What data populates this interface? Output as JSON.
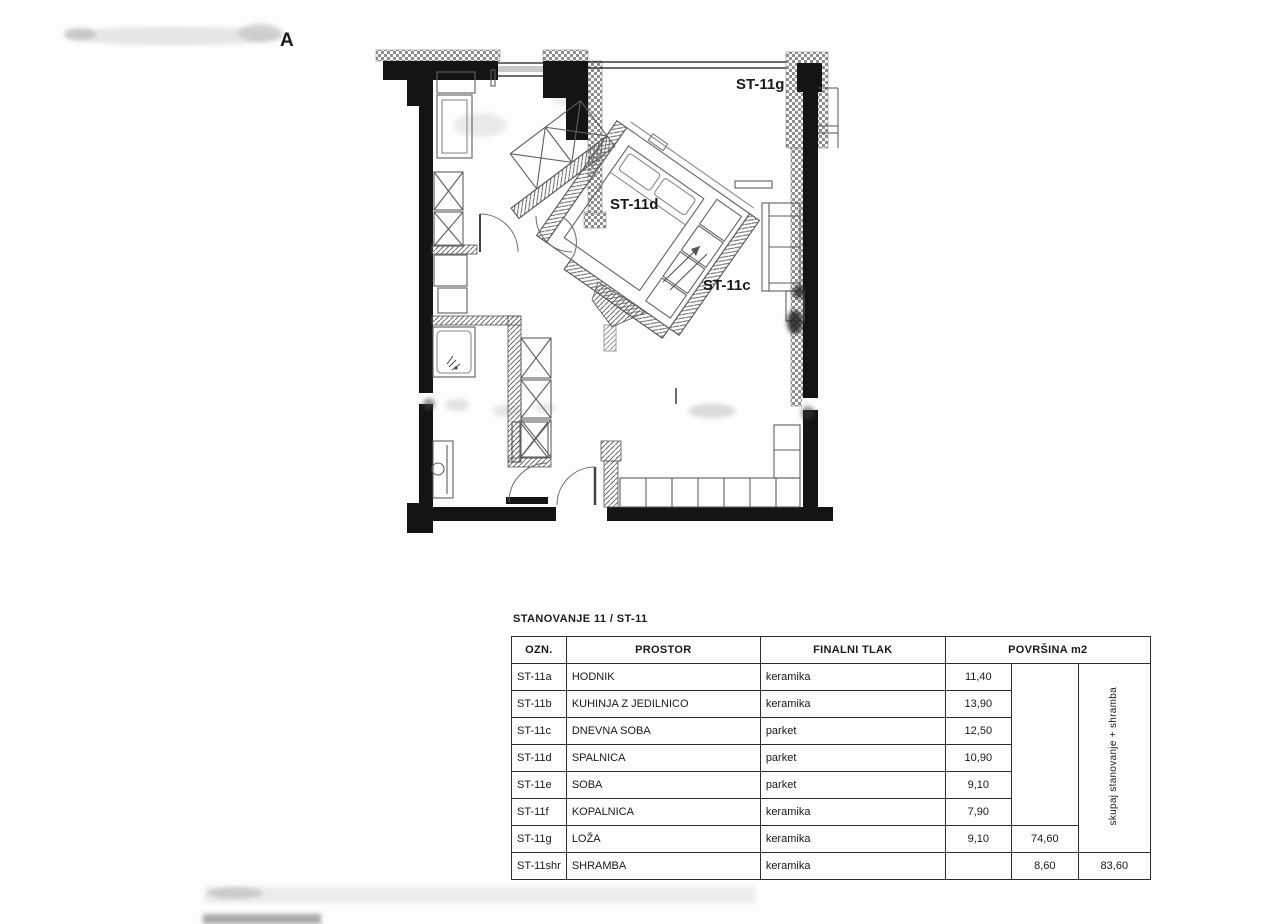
{
  "plan": {
    "corner_label": "A",
    "labels": {
      "loggia": "ST-11g",
      "bedroom": "ST-11d",
      "living": "ST-11c"
    },
    "ink_color": "#141414",
    "hatch_color": "#666666"
  },
  "table": {
    "title": "STANOVANJE 11 / ST-11",
    "headers": {
      "ozn": "OZN.",
      "prostor": "PROSTOR",
      "tlak": "FINALNI TLAK",
      "povrsina": "POVRŠINA m2"
    },
    "rotated_note": "skupaj stanovanje + shramba",
    "rows": [
      {
        "ozn": "ST-11a",
        "prostor": "HODNIK",
        "tlak": "keramika",
        "area": "11,40"
      },
      {
        "ozn": "ST-11b",
        "prostor": "KUHINJA Z JEDILNICO",
        "tlak": "keramika",
        "area": "13,90"
      },
      {
        "ozn": "ST-11c",
        "prostor": "DNEVNA SOBA",
        "tlak": "parket",
        "area": "12,50"
      },
      {
        "ozn": "ST-11d",
        "prostor": "SPALNICA",
        "tlak": "parket",
        "area": "10,90"
      },
      {
        "ozn": "ST-11e",
        "prostor": "SOBA",
        "tlak": "parket",
        "area": "9,10"
      },
      {
        "ozn": "ST-11f",
        "prostor": "KOPALNICA",
        "tlak": "keramika",
        "area": "7,90"
      },
      {
        "ozn": "ST-11g",
        "prostor": "LOŽA",
        "tlak": "keramika",
        "area": "9,10",
        "subtotal": "74,60"
      },
      {
        "ozn": "ST-11shr",
        "prostor": "SHRAMBA",
        "tlak": "keramika",
        "area": "",
        "subtotal": "8,60",
        "total": "83,60"
      }
    ]
  }
}
